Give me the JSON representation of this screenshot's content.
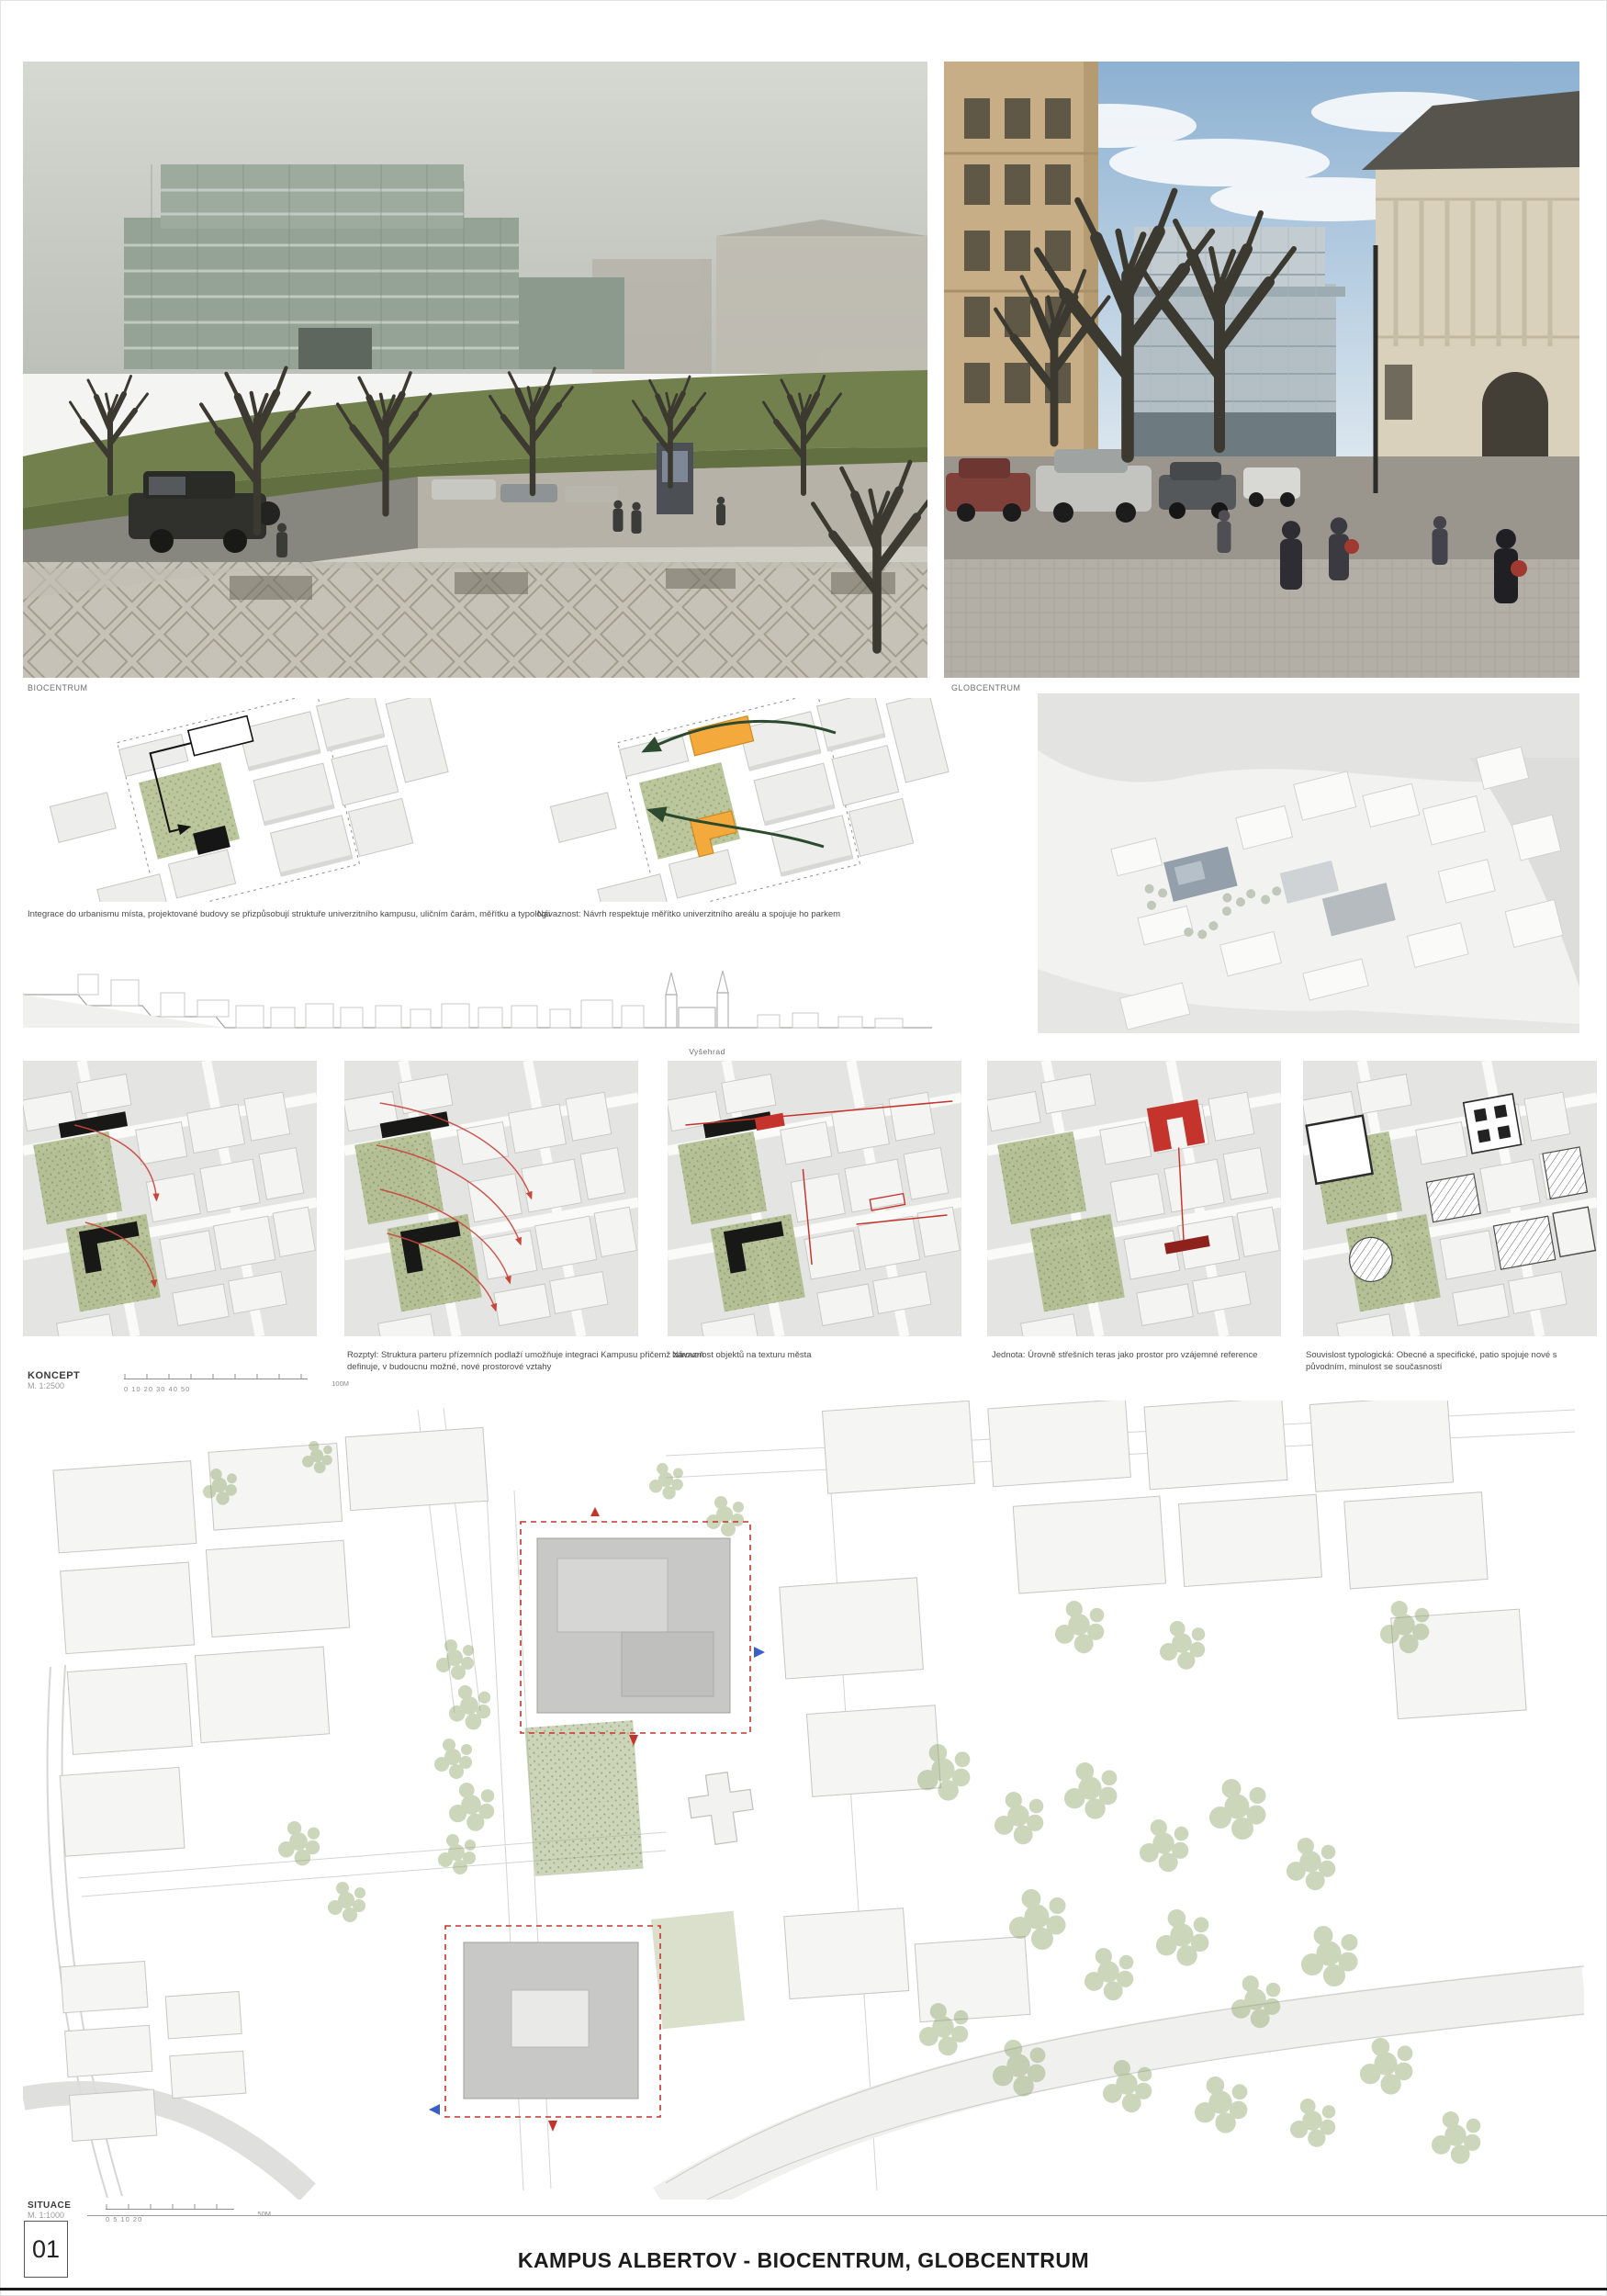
{
  "board": {
    "number": "01",
    "title": "KAMPUS ALBERTOV - BIOCENTRUM, GLOBCENTRUM"
  },
  "photos": {
    "left_label": "BIOCENTRUM",
    "right_label": "GLOBCENTRUM"
  },
  "axon": {
    "caption_left": "Integrace do urbanismu místa, projektované budovy se přizpůsobují struktuře univerzitního kampusu, uličním čarám, měřítku a typologii",
    "caption_right": "Návaznost: Návrh respektuje měřítko univerzitního areálu a spojuje ho parkem"
  },
  "section": {
    "label": "Vyšehrad"
  },
  "koncept": {
    "title": "KONCEPT",
    "scale": "M. 1:2500",
    "scalebar_ticks": "0 10 20 30 40 50",
    "scalebar_end": "100M",
    "captions": [
      "",
      "Rozptyl: Struktura parteru přízemních podlaží umožňuje integraci Kampusu přičemž zároveň definuje, v budoucnu možné, nové prostorové vztahy",
      "Návaznost objektů na texturu města",
      "Jednota: Úrovně střešních teras jako prostor pro vzájemné reference",
      "Souvislost typologická: Obecné a specifické, patio spojuje nové s původním, minulost se současností"
    ]
  },
  "situace": {
    "title": "SITUACE",
    "scale": "M. 1:1000",
    "scalebar_ticks": "0 5 10 20",
    "scalebar_end": "50M"
  },
  "colors": {
    "accent_red": "#c5342c",
    "accent_orange": "#f3a93c",
    "park_green": "#a9b786",
    "arrow_green": "#2c4a2e"
  }
}
